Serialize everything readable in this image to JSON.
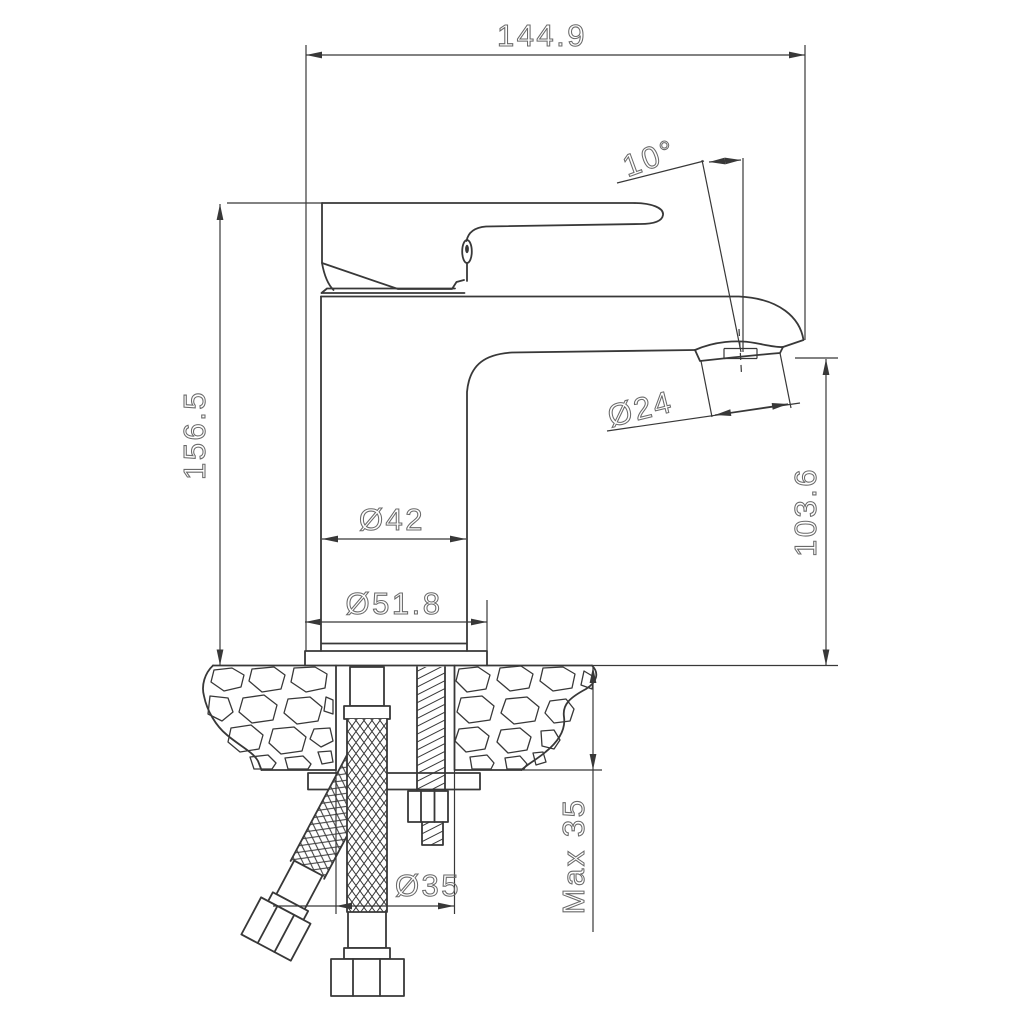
{
  "drawing": {
    "kind": "technical dimension drawing",
    "subject": "single-lever basin faucet, side elevation with mounting section",
    "colors": {
      "background": "#ffffff",
      "lines": "#383838",
      "dimension_text": "#6a6a6a"
    },
    "labels": {
      "overall_width": "144.9",
      "handle_angle": "10°",
      "overall_height": "156.5",
      "aerator_diameter": "Ø24",
      "body_diameter": "Ø42",
      "base_diameter": "Ø51.8",
      "spout_height": "103.6",
      "max_mounting_thickness": "Max 35",
      "mounting_hole_diameter": "Ø35"
    }
  }
}
